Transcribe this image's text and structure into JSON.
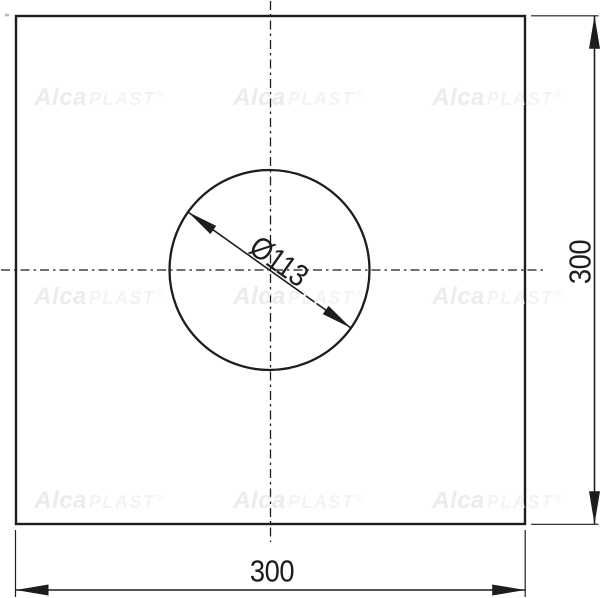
{
  "drawing": {
    "plate": {
      "width_label": "300",
      "height_label": "300"
    },
    "hole": {
      "diameter_label": "Ø113"
    },
    "colors": {
      "line": "#1d1d1b",
      "background": "#ffffff",
      "watermark_strong": "#ececec",
      "watermark_faint": "#f3f3f3"
    }
  },
  "watermark": {
    "brand_bold": "Alca",
    "brand_light": "PLAST",
    "registered_mark": "®"
  }
}
